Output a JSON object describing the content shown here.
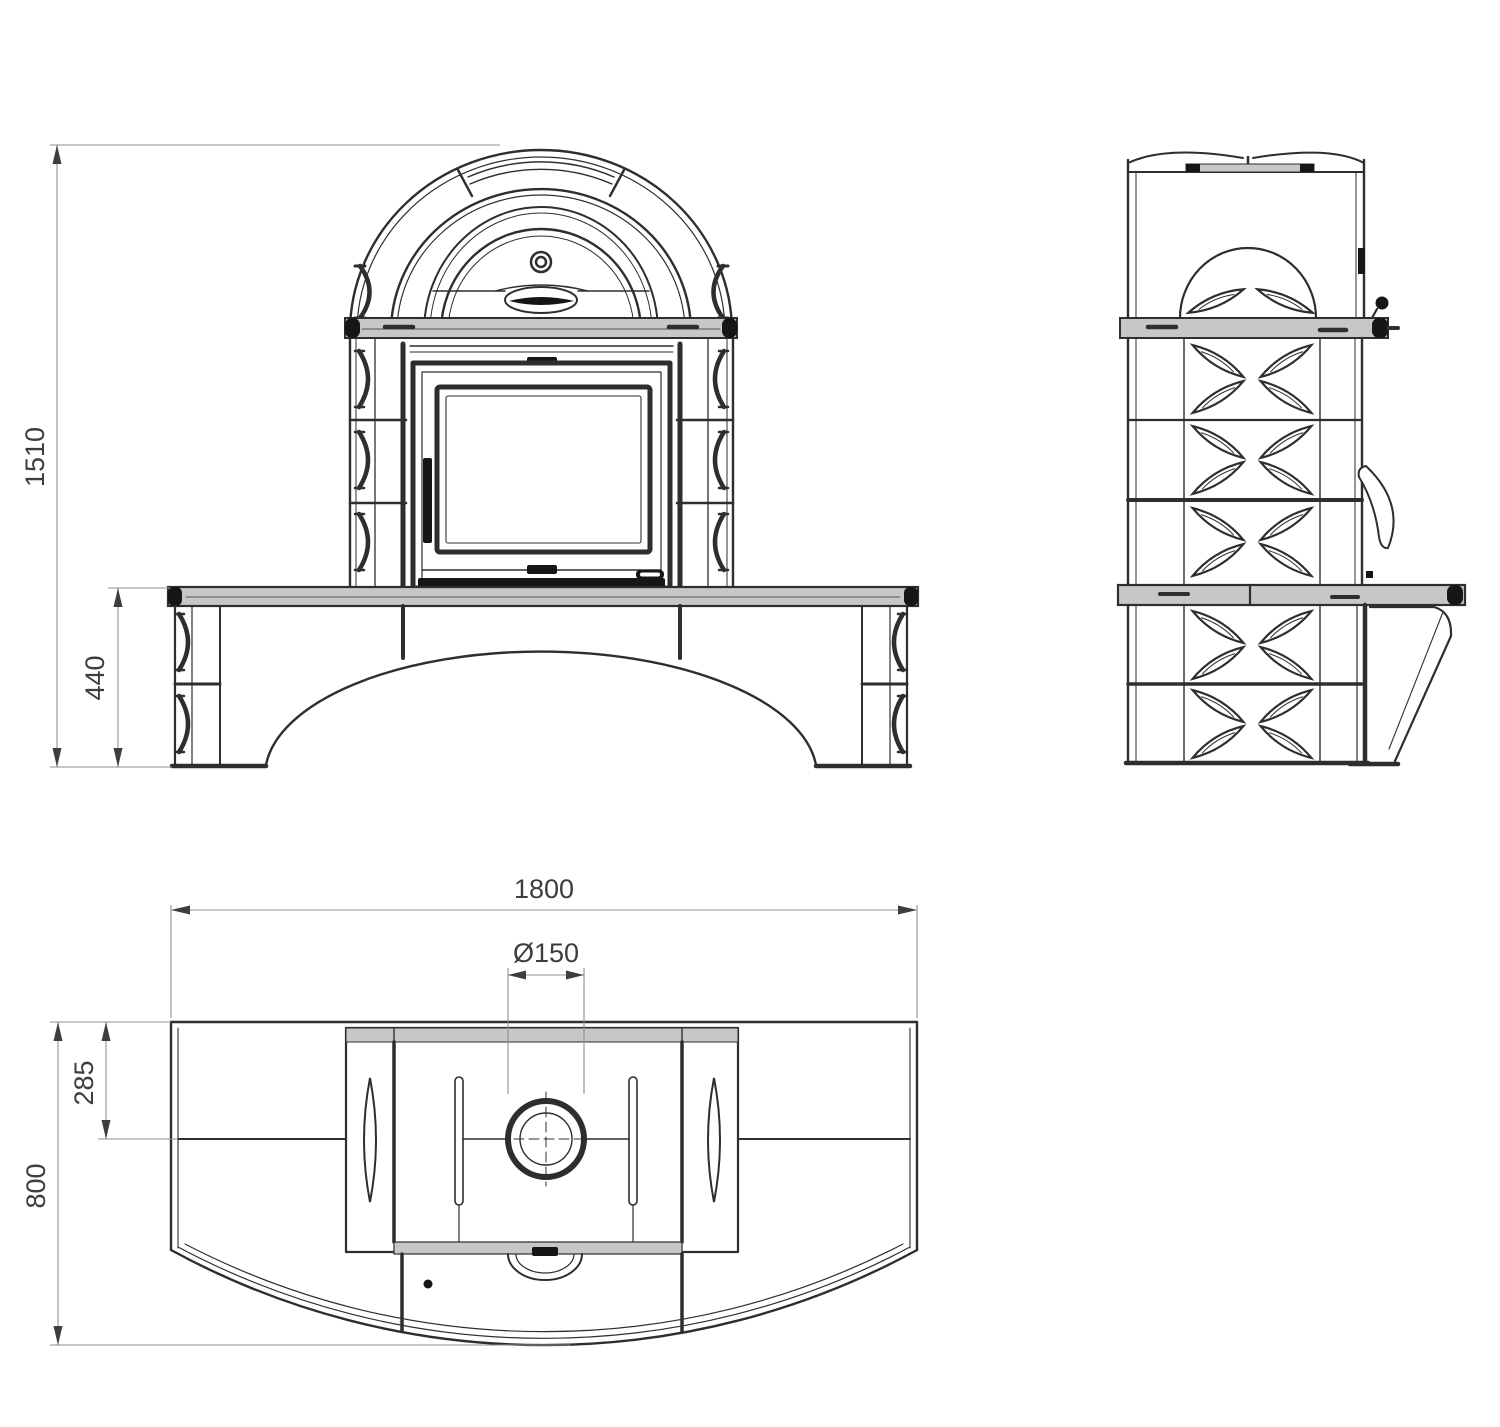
{
  "dimensions": {
    "front_height": "1510",
    "bench_height": "440",
    "plan_width": "1800",
    "flue_diameter": "Ø150",
    "flue_offset": "285",
    "plan_depth": "800"
  },
  "colors": {
    "background": "#ffffff",
    "line": "#2e2e2e",
    "line_dark": "#161616",
    "fill_light": "#c7c7c7",
    "dim_line": "#8f8f8f",
    "dim_text": "#3d3d3d"
  }
}
